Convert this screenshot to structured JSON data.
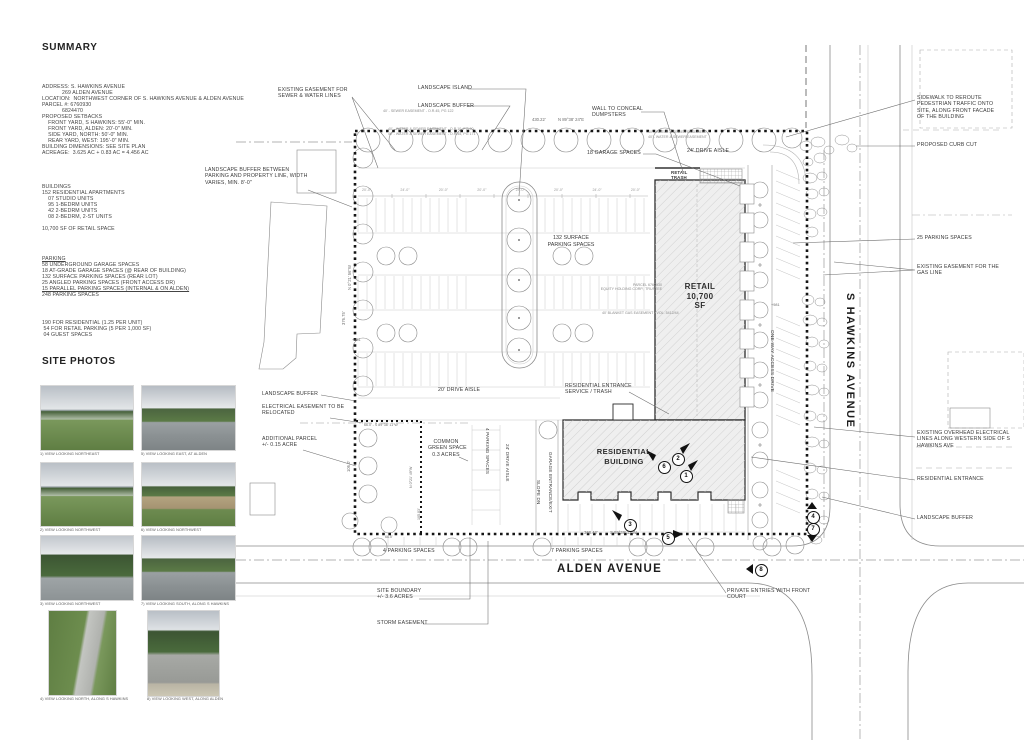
{
  "doc": {
    "summary_title": "SUMMARY",
    "photos_title": "SITE PHOTOS"
  },
  "summary": {
    "info": [
      "ADDRESS: S. HAWKINS AVENUE",
      "             269 ALDEN AVENUE",
      "LOCATION:  NORTHWEST CORNER OF S. HAWKINS AVENUE & ALDEN AVENUE",
      "PARCEL #: 6760930",
      "             6824470",
      "PROPOSED SETBACKS",
      "    FRONT YARD, S HAWKINS: 55'-0\" MIN.",
      "    FRONT YARD, ALDEN: 20'-0\" MIN.",
      "    SIDE YARD, NORTH: 50'-0\" MIN.",
      "    REAR YARD, WEST: 195'-0\" MIN.",
      "BUILDING DIMENSIONS: SEE SITE PLAN",
      "ACREAGE:  3.625 AC + 0.83 AC = 4.456 AC"
    ],
    "buildings": [
      "BUILDINGS",
      "152 RESIDENTIAL APARTMENTS",
      "    07 STUDIO UNITS",
      "    95 1-BEDRM UNITS",
      "    42 2-BEDRM UNITS",
      "    08 2-BEDRM, 2-ST UNITS",
      "",
      "10,700 SF OF RETAIL SPACE"
    ],
    "parking": [
      {
        "text": "PARKING",
        "u": true
      },
      "58 UNDERGROUND GARAGE SPACES",
      "18 AT-GRADE GARAGE SPACES (@ REAR OF BUILDING)",
      "132 SURFACE PARKING SPACES (REAR LOT)",
      "25 ANGLED PARKING SPACES (FRONT ACCESS DR)",
      {
        "text": "15 PARALLEL PARKING SPACES (INTERNAL & ON ALDEN)",
        "u": true
      },
      "248 PARKING SPACES"
    ],
    "parking_totals": [
      "190 FOR RESIDENTIAL (1.25 PER UNIT)",
      " 54 FOR RETAIL PARKING (5 PER 1,000 SF)",
      " 04 GUEST SPACES"
    ]
  },
  "photos": [
    {
      "caption": "1) VIEW LOOKING NORTHEAST"
    },
    {
      "caption": "5) VIEW LOOKING EAST, AT ALDEN"
    },
    {
      "caption": "2) VIEW LOOKING NORTHWEST"
    },
    {
      "caption": "6) VIEW LOOKING NORTHWEST"
    },
    {
      "caption": "3) VIEW LOOKING NORTHWEST"
    },
    {
      "caption": "7) VIEW LOOKING SOUTH, ALONG S HAWKINS"
    },
    {
      "caption": "4) VIEW LOOKING NORTH, ALONG S HAWKINS"
    },
    {
      "caption": "8) VIEW LOOKING WEST, ALONG ALDEN"
    }
  ],
  "plan": {
    "streets": {
      "hawkins": "S HAWKINS AVENUE",
      "alden": "ALDEN AVENUE"
    },
    "retail": [
      "RETAIL",
      "10,700",
      "SF"
    ],
    "residential": [
      "RESIDENTIAL",
      "BUILDING"
    ],
    "callouts": {
      "sewer_water": [
        "EXISTING EASEMENT FOR",
        "SEWER & WATER LINES"
      ],
      "landscape_island": "LANDSCAPE ISLAND",
      "landscape_buffer_top": "LANDSCAPE BUFFER",
      "wall_dumpsters": [
        "WALL TO CONCEAL",
        "DUMPSTERS"
      ],
      "garage_18": "18 GARAGE SPACES",
      "drive_24_top": "24' DRIVE AISLE",
      "retail_trash": [
        "RETAIL",
        "TRASH"
      ],
      "buffer_between": [
        "LANDSCAPE BUFFER BETWEEN",
        "PARKING AND PROPERTY LINE, WIDTH",
        "VARIES, MIN. 8'-0\""
      ],
      "surface_132": [
        "132 SURFACE",
        "PARKING SPACES"
      ],
      "drive_20": "20' DRIVE AISLE",
      "landscape_buffer_left": "LANDSCAPE BUFFER",
      "electrical": [
        "ELECTRICAL EASEMENT TO BE",
        "RELOCATED"
      ],
      "additional_parcel": [
        "ADDITIONAL PARCEL",
        "+/- 0.15 ACRE"
      ],
      "common_green": [
        "COMMON",
        "GREEN SPACE",
        "0.3 ACRES"
      ],
      "res_entrance_service": [
        "RESIDENTIAL ENTRANCE",
        "SERVICE / TRASH"
      ],
      "parking_4": "4 PARKING SPACES",
      "parking_7": "7 PARKING SPACES",
      "site_boundary": [
        "SITE BOUNDARY",
        "+/- 3.6 ACRES"
      ],
      "storm": "STORM EASEMENT",
      "private_entries": [
        "PRIVATE ENTRIES WITH FRONT",
        "COURT"
      ],
      "sidewalk_reroute": [
        "SIDEWALK TO REROUTE",
        "PEDESTRIAN TRAFFIC ONTO",
        "SITE, ALONG FRONT FACADE",
        "OF THE BUILDING"
      ],
      "curb_cut": "PROPOSED CURB CUT",
      "parking_25": "25 PARKING SPACES",
      "gas_line": [
        "EXISTING EASEMENT FOR THE",
        "GAS LINE"
      ],
      "overhead": [
        "EXISTING OVERHEAD ELECTRICAL",
        "LINES ALONG WESTERN SIDE OF S",
        "HAWKINS AVE"
      ],
      "res_entrance": "RESIDENTIAL ENTRANCE",
      "landscape_buffer_right": "LANDSCAPE BUFFER",
      "parking_4_vert": "4 PARKING SPACES",
      "drive_24_vert": "24' DRIVE AISLE",
      "garage_entrance": "GARAGE ENTRANCE/EXIT",
      "slope_dn": "SLOPE DN",
      "one_way": "ONE-WAY ACCESS DRIVE"
    },
    "dims": {
      "top_len": "430.22'",
      "top_bearing": "N 89°38' 24\"E",
      "bottom_len": "368.43'",
      "bottom_bearing": "S 89°38' 11\"W",
      "left_bearing": "N 0°21' 56\"W",
      "left_len": "376.75'",
      "left_len2": "106.0'",
      "parcel_top": "66.0' - S 89°38' 11\"W",
      "parcel_right_bearing": "N 0°21' 49\"W",
      "parcel_right_len": "105.83'",
      "parcel_bottom": "66.0'",
      "spot1": "+981",
      "spot2": "+981",
      "stalls": [
        "20'-0\"",
        "24'-0\"",
        "20'-0\"",
        "20'-0\"",
        "24'-0\"",
        "20'-0\"",
        "24'-0\"",
        "20'-0\""
      ]
    },
    "notes": {
      "parcel_owner": [
        "PARCEL 6760930",
        "EQUITY HOLDING CORP., TRUSTEE"
      ],
      "gas_blanket": "40' BLANKET GAS EASEMENT - VOL. 5412/44",
      "easement1": "40' - SEWER EASEMENT - O.R.45, PG 122",
      "easement2": "40' - WATER & SEWER EASEMENT - O.R.10, PG 90",
      "easement3": "40' - WATER & SEWER EASEMENT - O.R.45, PG 171",
      "easement4": "40' - WATER & SEWER EASEMENT",
      "easement5": "40' - WATER & SEWER EASEMENT"
    },
    "markers": [
      "1",
      "2",
      "3",
      "4",
      "5",
      "6",
      "7",
      "8"
    ]
  }
}
